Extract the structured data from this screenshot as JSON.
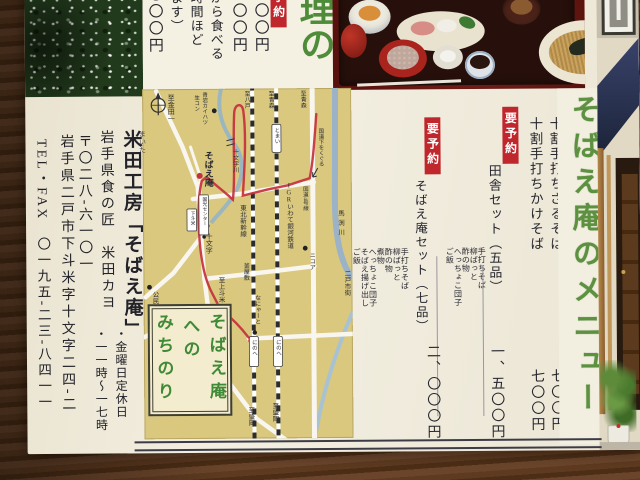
{
  "colors": {
    "title_green": "#5c9140",
    "badge_red": "#c0272d",
    "map_bg": "#d9c87e",
    "route_red": "#c5303c"
  },
  "top_panel": {
    "title_fragment": "理の",
    "badge": "要予約",
    "price_1": "、〇〇〇円",
    "price_2": "、〇〇〇円",
    "price_3": "、〇〇〇円",
    "note_1": "てから食べる",
    "note_2": "二時間ほど",
    "note_3": "ります）"
  },
  "menu": {
    "title": "そばえ庵のメニュー",
    "items": [
      {
        "name": "十割手打ちざるそば",
        "price": "七〇〇円"
      },
      {
        "name": "十割手打ちかけそば",
        "price": "七〇〇円"
      }
    ],
    "sets": [
      {
        "badge": "要予約",
        "name": "田舎セット（五品）",
        "price": "一、五〇〇円",
        "contents": [
          "手打ちそば",
          "柳ばっと",
          "酢の物",
          "へっちょこ団子",
          "ご飯"
        ]
      },
      {
        "badge": "要予約",
        "name": "そばえ庵セット（七品）",
        "price": "二、〇〇〇円",
        "contents": [
          "手打ちそば",
          "柳ばっと",
          "酢の物",
          "煮物",
          "へっちょこ団子",
          "そばえ揚げ出し",
          "ご飯"
        ]
      }
    ]
  },
  "map": {
    "title_col1": "そばえ庵",
    "title_col2": "への",
    "title_col3": "みちのり",
    "labels": {
      "to_kindaichi": "至金田一",
      "seigan": "青岩カイハツ",
      "namakon": "生コン",
      "to_hachinohe": "至八戸",
      "to_aomori_igr": "至青森",
      "to_aomori_r4": "至青森",
      "tomai": "とまい",
      "under_r4": "国道下をくぐる",
      "route4": "国道4号線",
      "jumonji_river": "十文字川",
      "sobaean": "そばえ庵",
      "center": "国光センター",
      "shimotomai": "下斗米",
      "shinkansen": "東北新幹線",
      "igr": "IGRいわて銀河鉄道",
      "nicoa": "ニコア",
      "mabechi": "馬渕川",
      "ninohe_city": "二戸市街",
      "kouminkan": "公民館",
      "to_kamitomai": "至上斗米",
      "kamayashiki": "釜屋敷",
      "nanyato": "なにゃーと",
      "ninohe1": "にのへ",
      "ninohe2": "にのへ",
      "to_morioka1": "至盛岡",
      "to_morioka2": "至盛岡",
      "jumonji": "十文字"
    }
  },
  "contact": {
    "furigana": "まいた",
    "company": "米田工房「そばえ庵」",
    "takumi": "岩手県食の匠　米田カヨ",
    "closed": "・金曜日定休日",
    "hours": "・一一時～一七時",
    "postal": "〒〇二八-六一〇一",
    "address": "岩手県二戸市下斗米字十文字二四-二",
    "tel": "TEL・FAX　〇一九五-二三-八四一一"
  }
}
